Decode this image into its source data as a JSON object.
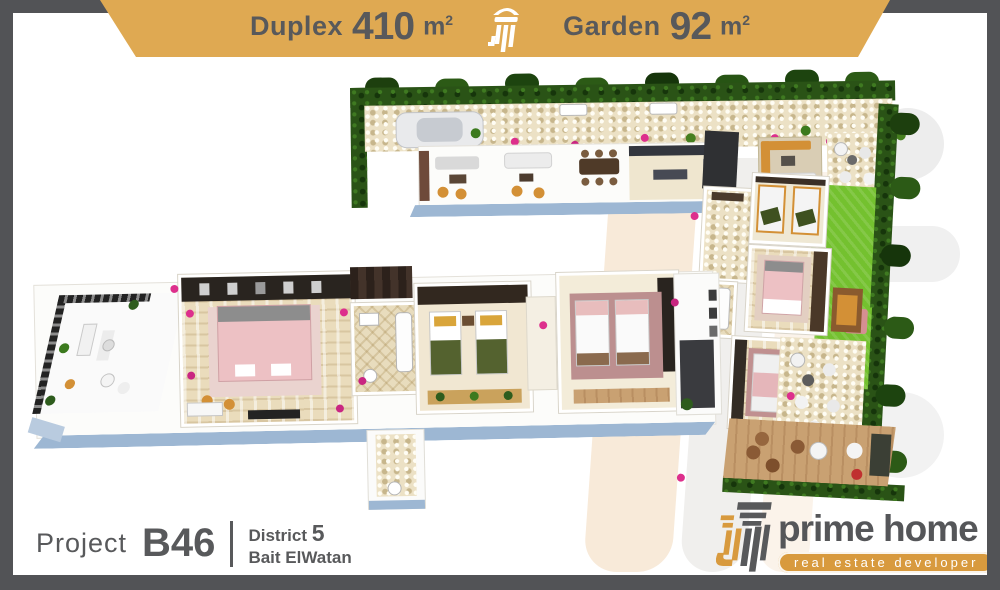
{
  "banner": {
    "left": {
      "label": "Duplex",
      "value": "410",
      "unit": "m",
      "unit_sup": "2"
    },
    "right": {
      "label": "Garden",
      "value": "92",
      "unit": "m",
      "unit_sup": "2"
    }
  },
  "footer": {
    "project_label": "Project",
    "project_code": "B46",
    "district_label": "District",
    "district_number": "5",
    "district_area": "Bait ElWatan"
  },
  "brand": {
    "name": "prime home",
    "tagline": "real estate developer"
  },
  "icons": {
    "banner_logo": "column-icon",
    "brand_logo": "column-icon"
  },
  "colors": {
    "frame": "#525356",
    "banner_gold": "#dfa952",
    "text_dark": "#58595b",
    "lawn_green": "#74c12f",
    "hedge_green": "#2a5316",
    "slab_edge_blue": "#9db7d3",
    "bed_pink": "#edc1c4",
    "gold_accent": "#d39036",
    "watermark_peach": "#f8ead9",
    "watermark_gray": "#efefef"
  }
}
